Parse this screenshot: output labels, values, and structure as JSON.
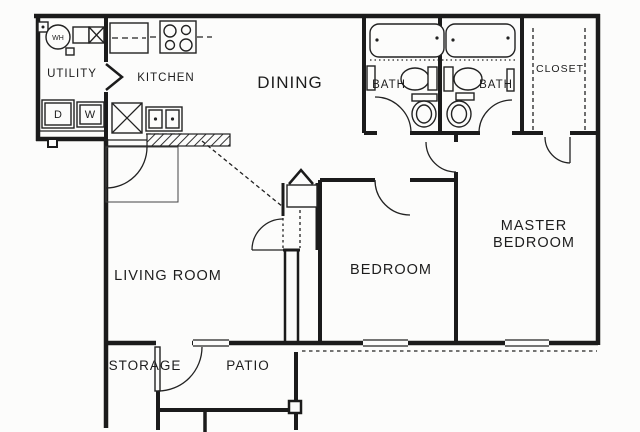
{
  "plan": {
    "type": "apartment-floor-plan",
    "colors": {
      "ink": "#1b1b1b",
      "paper": "#fcfcfb"
    },
    "rooms": {
      "utility": {
        "label": "UTILITY"
      },
      "kitchen": {
        "label": "KITCHEN"
      },
      "dining": {
        "label": "DINING"
      },
      "bath1": {
        "label": "BATH"
      },
      "bath2": {
        "label": "BATH"
      },
      "closet": {
        "label": "CLOSET"
      },
      "living": {
        "label": "LIVING ROOM"
      },
      "bedroom": {
        "label": "BEDROOM"
      },
      "master": {
        "line1": "MASTER",
        "line2": "BEDROOM"
      },
      "storage": {
        "label": "STORAGE"
      },
      "patio": {
        "label": "PATIO"
      }
    },
    "fixtures": {
      "water_heater": {
        "label": "WH"
      },
      "dryer": {
        "label": "D"
      },
      "washer": {
        "label": "W"
      }
    }
  }
}
